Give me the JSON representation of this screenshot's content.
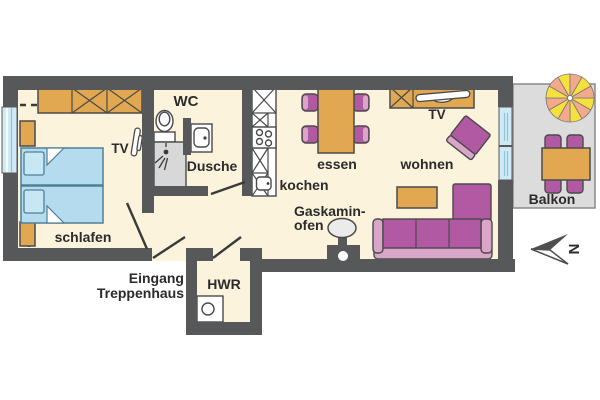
{
  "title": "Apartment floor plan",
  "labels": {
    "wc": "WC",
    "dusche": "Dusche",
    "kochen": "kochen",
    "essen": "essen",
    "wohnen": "wohnen",
    "schlafen": "schlafen",
    "hwr": "HWR",
    "balkon": "Balkon",
    "tv_bedroom": "TV",
    "tv_living": "TV",
    "gaskamin_line1": "Gaskamin-",
    "gaskamin_line2": "ofen",
    "entrance_line1": "Eingang",
    "entrance_line2": "Treppenhaus",
    "north": "N"
  },
  "colors": {
    "wall": "#57585a",
    "floor": "#fbf3dc",
    "balcony_floor": "#dcdcdc",
    "furniture_wood": "#e2a851",
    "bed_blue": "#b4dcee",
    "window_blue": "#cfeaf4",
    "upholstery_purple": "#b259a4",
    "upholstery_light_purple": "#d9a6c9",
    "parasol_yellow": "#f5e13d",
    "parasol_salmon": "#f3a98b",
    "shower_gray": "#d8d8d8",
    "label_text": "#2b2b2b"
  }
}
